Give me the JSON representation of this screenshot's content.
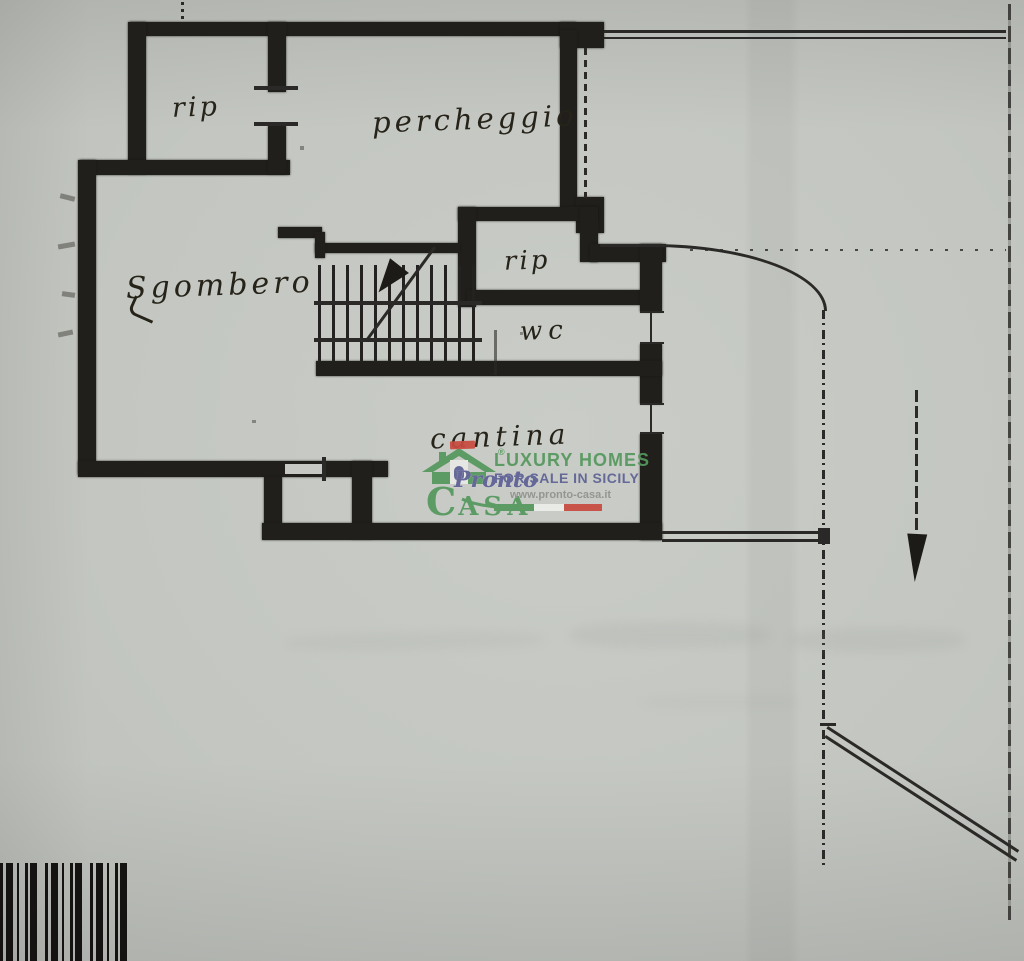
{
  "rooms": [
    {
      "id": "rip-top",
      "label": "rip"
    },
    {
      "id": "parcheggio",
      "label": "percheggio"
    },
    {
      "id": "sgombero",
      "label": "Sgombero"
    },
    {
      "id": "rip-mid",
      "label": "rip"
    },
    {
      "id": "wc",
      "label": "wc"
    },
    {
      "id": "cantina",
      "label": "cantina"
    }
  ],
  "watermark": {
    "brand_script": "Pronto",
    "brand_caps_initial": "C",
    "brand_caps_rest": "ASA",
    "registered_symbol": "®",
    "tagline1": "LUXURY HOMES",
    "tagline2": "FOR SALE IN SICILY",
    "website": "www.pronto-casa.it",
    "accent_green": "#55985e",
    "accent_purple": "#5e6295",
    "flag_red": "#c84a40"
  }
}
